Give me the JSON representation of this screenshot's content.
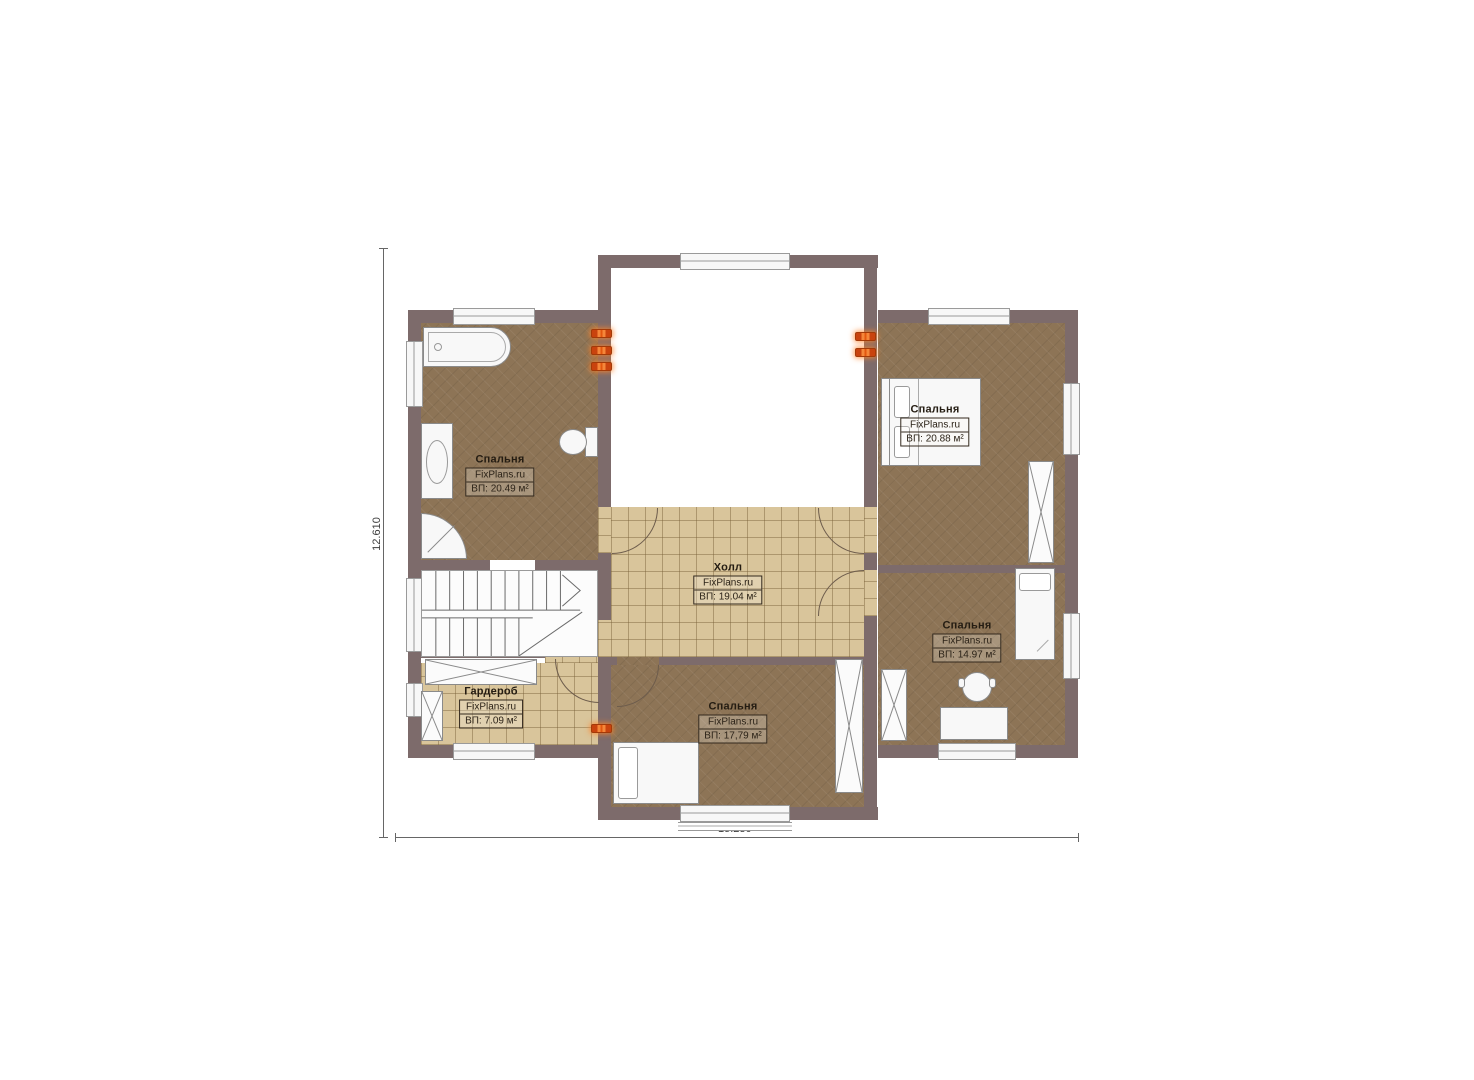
{
  "plan": {
    "colors": {
      "wall": "#7d6b6b",
      "bedroom_floor": "#8d7456",
      "tile_floor": "#d9c59b",
      "vent_marker_orange": "#e8551f",
      "background": "#ffffff"
    },
    "rooms": [
      {
        "id": "bedroom-left",
        "name": "Спальня",
        "brand": "FixPlans.ru",
        "area": "ВП: 20.49 м²"
      },
      {
        "id": "bedroom-top-right",
        "name": "Спальня",
        "brand": "FixPlans.ru",
        "area": "ВП: 20.88 м²"
      },
      {
        "id": "hall",
        "name": "Холл",
        "brand": "FixPlans.ru",
        "area": "ВП: 19.04 м²"
      },
      {
        "id": "bedroom-bottom",
        "name": "Спальня",
        "brand": "FixPlans.ru",
        "area": "ВП: 17,79 м²"
      },
      {
        "id": "bedroom-right",
        "name": "Спальня",
        "brand": "FixPlans.ru",
        "area": "ВП: 14.97 м²"
      },
      {
        "id": "wardrobe",
        "name": "Гардероб",
        "brand": "FixPlans.ru",
        "area": "ВП: 7.09 м²"
      }
    ],
    "dimensions": {
      "overall_width": "15.230",
      "overall_height": "12.610"
    }
  }
}
